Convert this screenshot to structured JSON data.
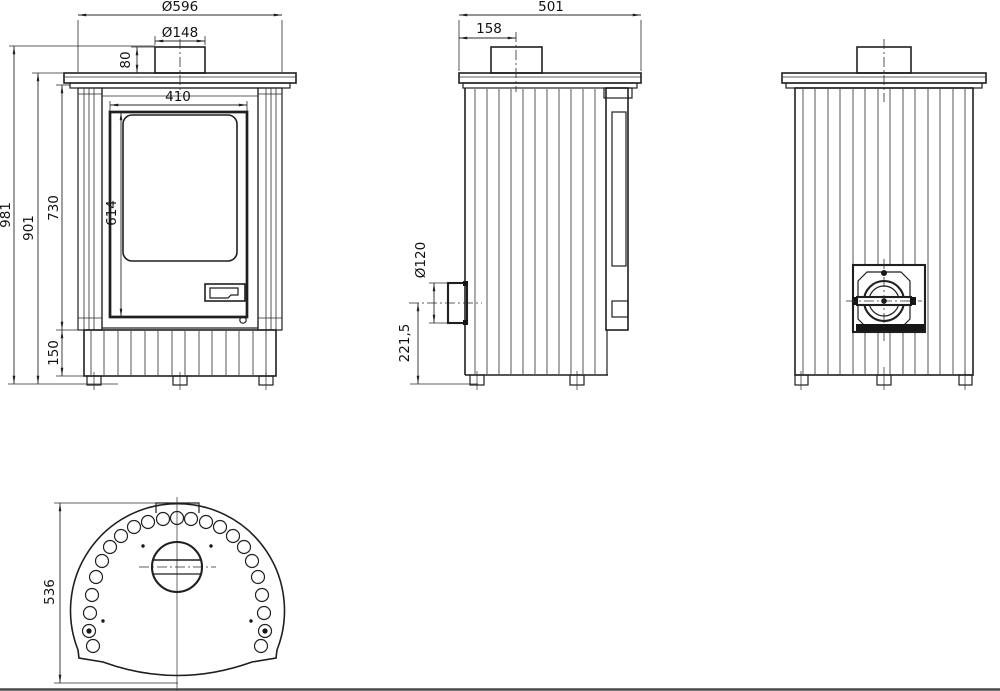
{
  "page": {
    "background": "#ffffff",
    "line_color": "#1f1f1f",
    "bottom_border_color": "#4a4a4a"
  },
  "dims": {
    "front": {
      "total_width": "Ø596",
      "flue_diameter": "Ø148",
      "collar_height": "80",
      "door_width": "410",
      "glass_height": "614",
      "door_height": "730",
      "body_height": "901",
      "total_height": "981",
      "plinth_height": "150"
    },
    "side": {
      "total_depth": "501",
      "flue_offset": "158",
      "inlet_diameter": "Ø120",
      "inlet_height": "221,5"
    },
    "top": {
      "total_depth": "536"
    }
  }
}
